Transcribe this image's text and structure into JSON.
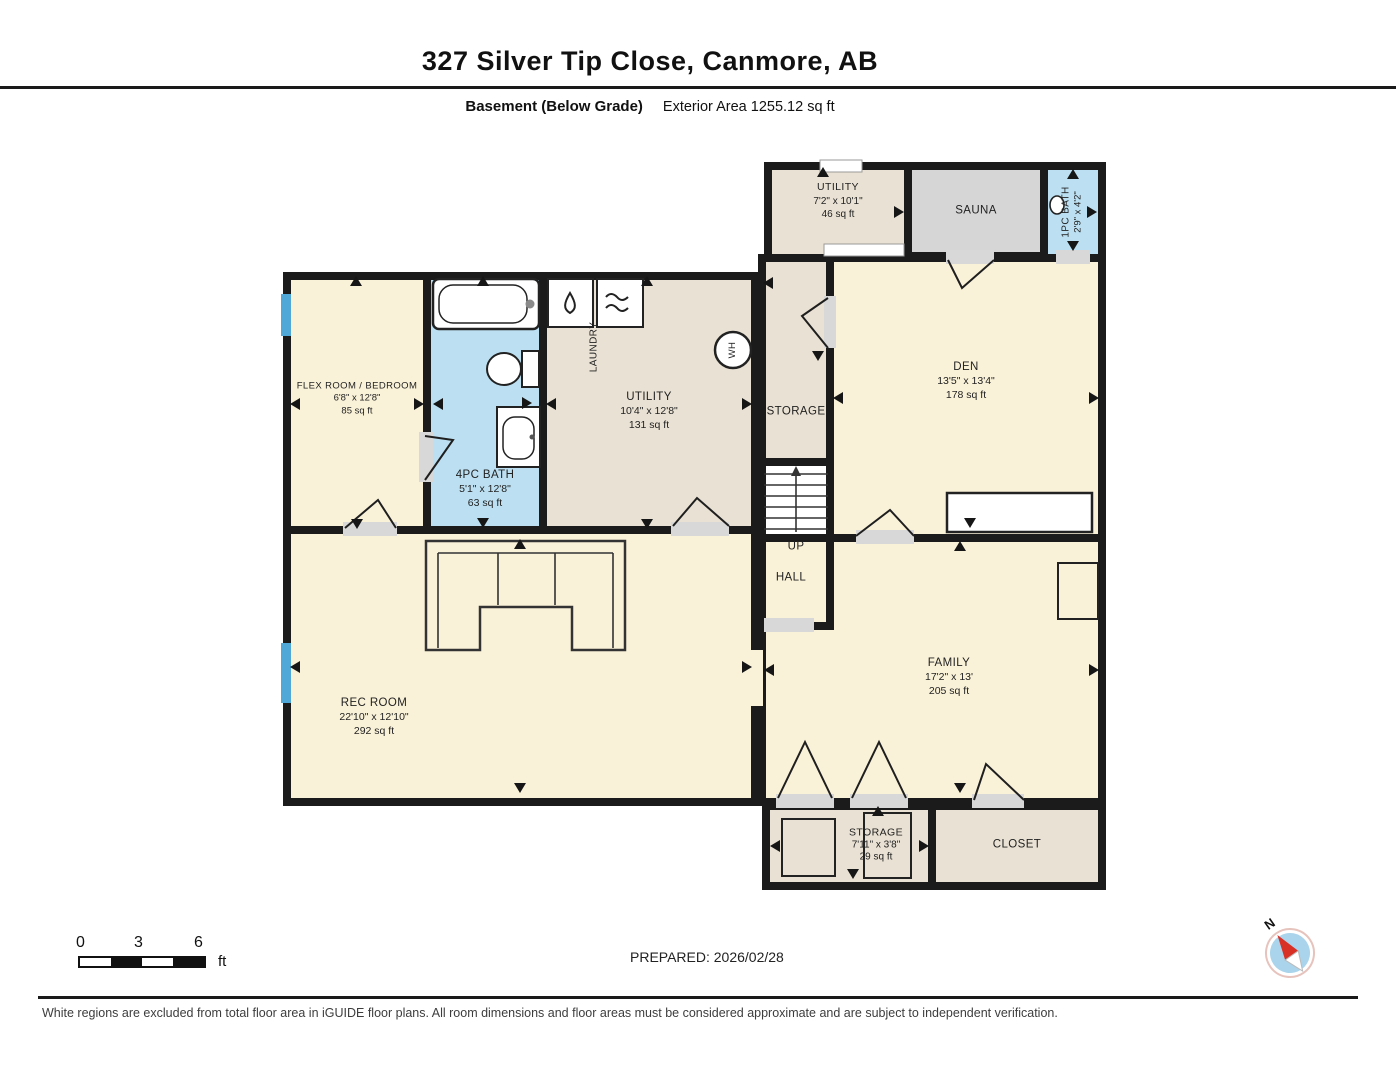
{
  "header": {
    "title": "327 Silver Tip Close, Canmore, AB",
    "floor_label": "Basement (Below Grade)",
    "area_label": "Exterior Area 1255.12 sq ft"
  },
  "rooms": {
    "utility_top": {
      "name": "UTILITY",
      "dims": "7'2\" x 10'1\"",
      "area": "46 sq ft"
    },
    "sauna": {
      "name": "SAUNA"
    },
    "bath_1pc": {
      "name": "1PC BATH",
      "dims": "2'9\" x 4'2\""
    },
    "flex": {
      "name": "FLEX ROOM / BEDROOM",
      "dims": "6'8\" x 12'8\"",
      "area": "85 sq ft"
    },
    "bath_4pc": {
      "name": "4PC BATH",
      "dims": "5'1\" x 12'8\"",
      "area": "63 sq ft"
    },
    "utility_main": {
      "name": "UTILITY",
      "dims": "10'4\" x 12'8\"",
      "area": "131 sq ft"
    },
    "laundry": {
      "name": "LAUNDRY"
    },
    "water_heater": {
      "name": "WH"
    },
    "storage_mid": {
      "name": "STORAGE"
    },
    "den": {
      "name": "DEN",
      "dims": "13'5\" x 13'4\"",
      "area": "178 sq ft"
    },
    "stairs": {
      "name": "UP"
    },
    "hall": {
      "name": "HALL"
    },
    "rec_room": {
      "name": "REC ROOM",
      "dims": "22'10\" x 12'10\"",
      "area": "292 sq ft"
    },
    "family": {
      "name": "FAMILY",
      "dims": "17'2\" x 13'",
      "area": "205 sq ft"
    },
    "storage_bottom": {
      "name": "STORAGE",
      "dims": "7'11\" x 3'8\"",
      "area": "29 sq ft"
    },
    "closet": {
      "name": "CLOSET"
    }
  },
  "scale_bar": {
    "tick_0": "0",
    "tick_3": "3",
    "tick_6": "6",
    "unit": "ft"
  },
  "prepared_label": "PREPARED: 2026/02/28",
  "compass": {
    "north": "N"
  },
  "disclaimer": "White regions are excluded from total floor area in iGUIDE floor plans. All room dimensions and floor areas must be considered approximate and are subject to independent verification.",
  "colors": {
    "room_cream": "#FAF2D8",
    "room_beige": "#E9E1D3",
    "room_gray": "#D6D6D6",
    "room_bath_blue": "#BCE0F2",
    "window_blue": "#4FA8D8",
    "wall_black": "#1B1B1B"
  }
}
